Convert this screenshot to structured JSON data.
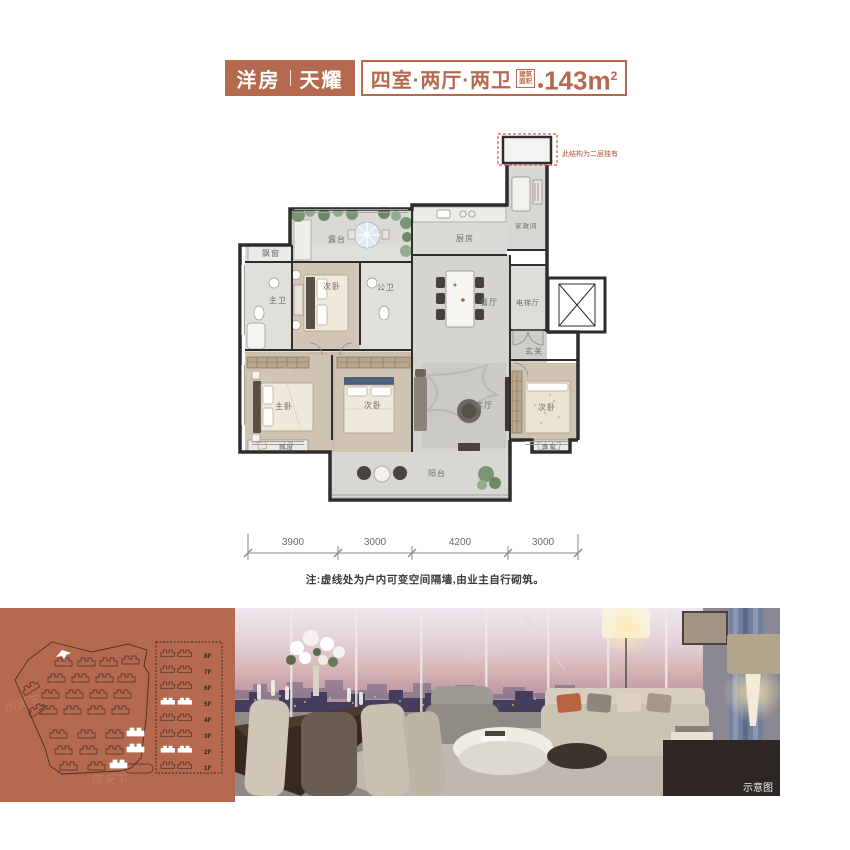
{
  "header": {
    "product_type": "洋房",
    "product_name": "天耀",
    "layout": "四室·两厅·两卫",
    "area_badge_line1": "建筑",
    "area_badge_line2": "面积",
    "area_value": "143m",
    "area_sup": "2"
  },
  "floorplan": {
    "annotation": "此结构为二层独有",
    "rooms": {
      "terrace": "露台",
      "bay_window": "飘窗",
      "bedroom_top": "次卧",
      "master_bath": "主卫",
      "public_bath": "公卫",
      "kitchen": "厨房",
      "housekeeping": "家政间",
      "dining": "餐厅",
      "elevator_hall": "电梯厅",
      "foyer": "玄关",
      "living": "客厅",
      "master_bedroom": "主卧",
      "bedroom_center": "次卧",
      "bedroom_right": "次卧",
      "balcony": "阳台"
    },
    "dimensions": [
      "3900",
      "3000",
      "4200",
      "3000"
    ],
    "note": "注:虚线处为户内可变空间隔墙,由业主自行砌筑。"
  },
  "site_panel": {
    "floors": [
      "8F",
      "7F",
      "6F",
      "5F",
      "4F",
      "3F",
      "2F",
      "1F"
    ],
    "highlighted_floors": [
      "5F",
      "2F"
    ]
  },
  "photo": {
    "caption": "示意图"
  },
  "watermark": "房天下",
  "colors": {
    "terracotta": "#b5694e",
    "dashed_red": "#dd5547",
    "wall": "#2d2d2d"
  }
}
